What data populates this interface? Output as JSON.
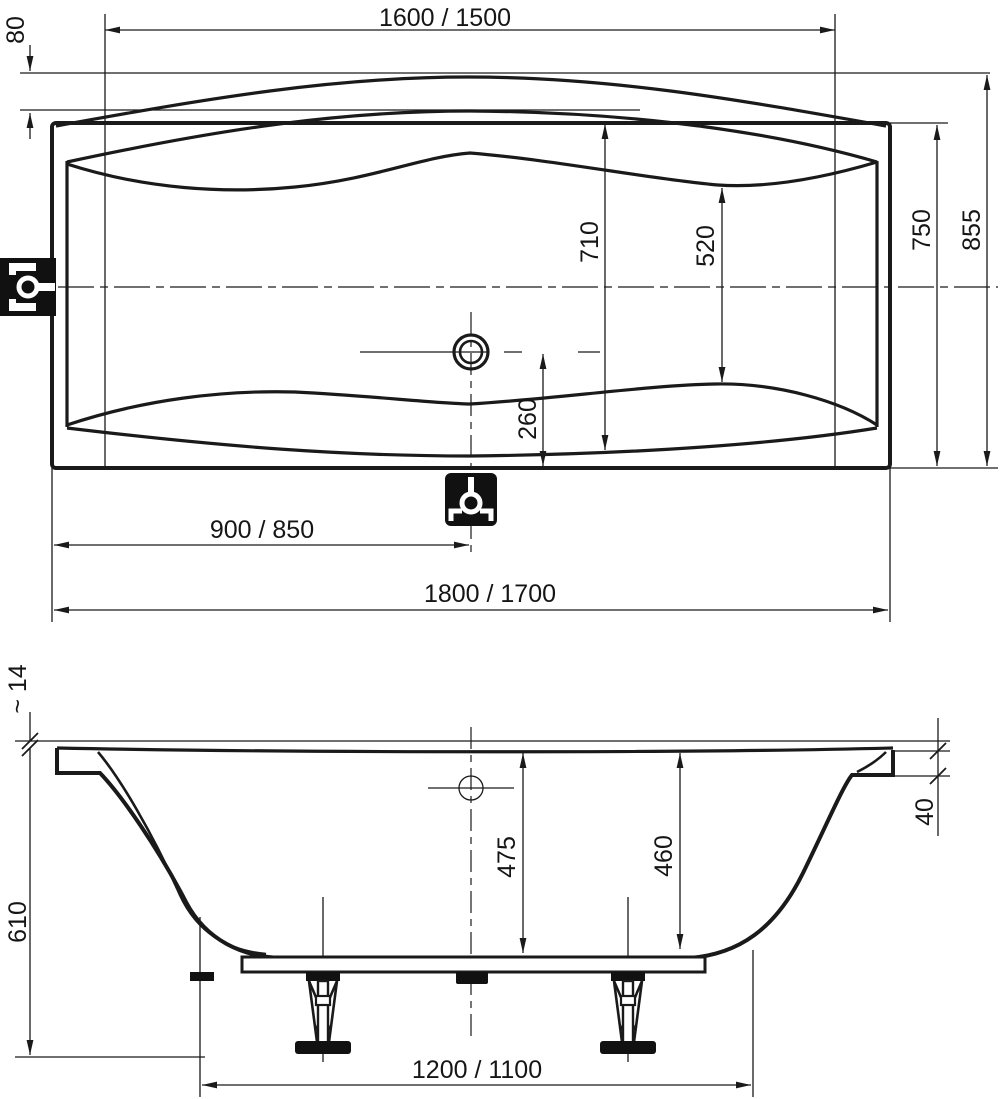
{
  "drawing": {
    "background": "#ffffff",
    "line_color": "#1a1a1a",
    "icon_bg": "#111111",
    "icon_fg": "#ffffff",
    "plan_view": {
      "dims": {
        "inner_length": "1600 / 1500",
        "rim_band": "80",
        "inner_width": "750",
        "overall_width": "855",
        "center_width": "710",
        "basin_width": "520",
        "drain_offset": "260",
        "drain_position": "900 / 850",
        "overall_length": "1800 / 1700"
      },
      "icons": {
        "overflow": "overflow-fitting-icon",
        "drain": "drain-fitting-icon"
      }
    },
    "side_view": {
      "dims": {
        "rim_thickness": "~ 14",
        "overall_height": "610",
        "rim_height": "40",
        "depth_at_drain": "475",
        "depth_at_end": "460",
        "support_span": "1200 / 1100"
      }
    }
  }
}
